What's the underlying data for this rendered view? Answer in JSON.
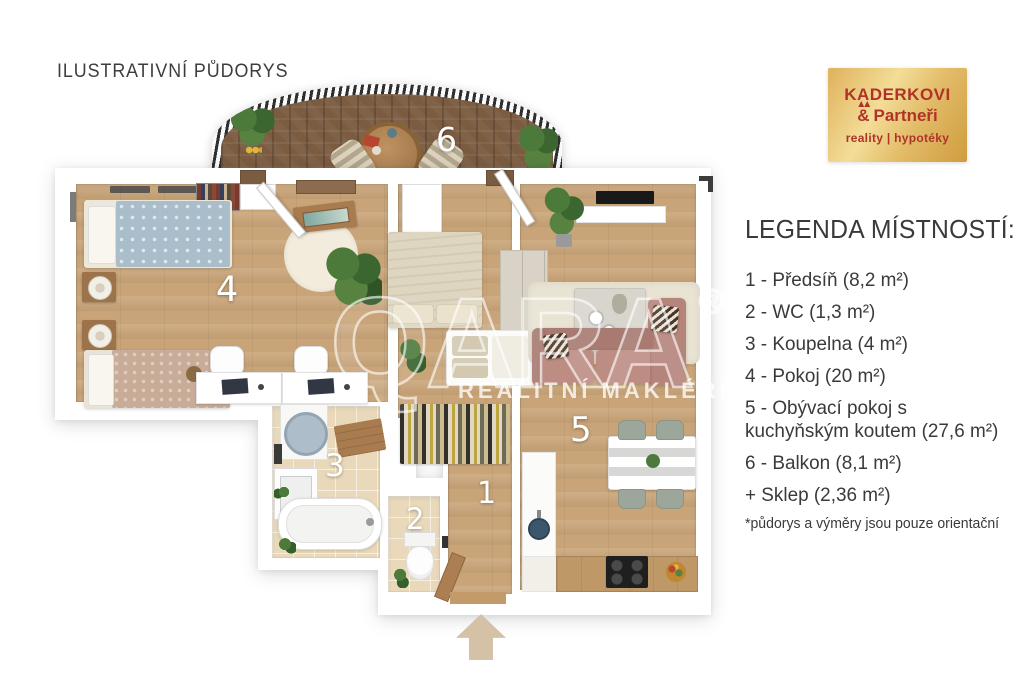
{
  "title": "ILUSTRATIVNÍ PŮDORYS",
  "logo": {
    "name": "KADERKOVI",
    "amp": "&",
    "partners": "Partneři",
    "tagline": "reality | hypotéky",
    "bg_gold": "#e2b65f",
    "text_red": "#b0332a"
  },
  "legend": {
    "heading": "LEGENDA MÍSTNOSTÍ:",
    "items": [
      "1 - Předsíň (8,2 m²)",
      "2 - WC (1,3 m²)",
      "3 - Koupelna (4 m²)",
      "4 - Pokoj (20 m²)",
      "5 - Obývací pokoj s kuchyňským koutem (27,6 m²)",
      "6 - Balkon (8,1 m²)",
      "+ Sklep (2,36 m²)"
    ],
    "footnote": "*půdorys a výměry jsou pouze orientační"
  },
  "plan": {
    "numbers": {
      "hall": "1",
      "wc": "2",
      "bath": "3",
      "room": "4",
      "living": "5",
      "balcony": "6"
    },
    "colors": {
      "floor_wood": "#c9a478",
      "balcony_wood": "#7b5c41",
      "tiles": "#e9d9ba",
      "walls": "#ffffff",
      "sofa": "#b5847b"
    }
  },
  "watermark": {
    "brand": "QARA",
    "registered": "®",
    "subtitle": "REALITNÍ MAKLÉŘI"
  }
}
